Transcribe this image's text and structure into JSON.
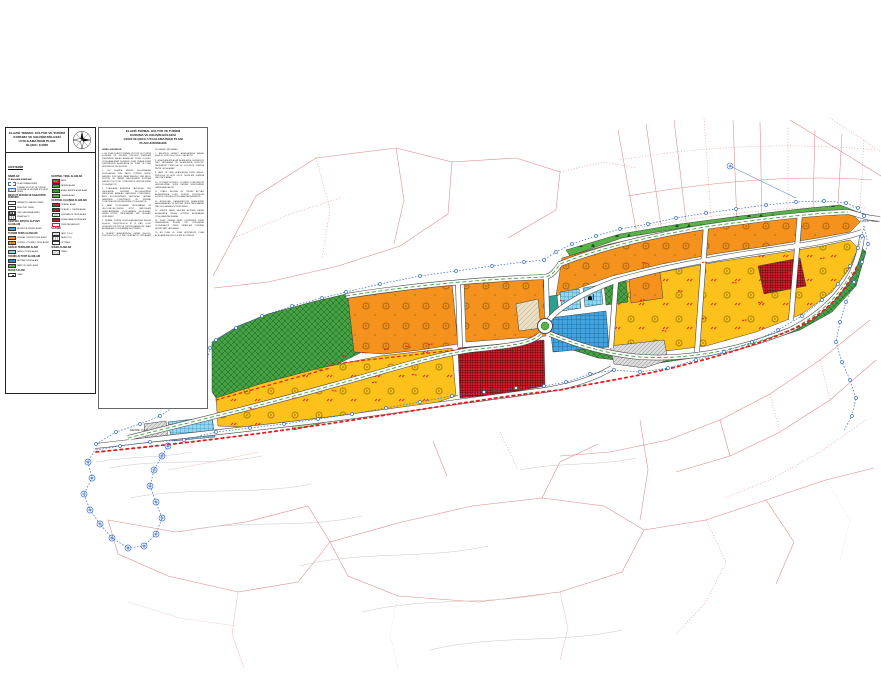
{
  "palette": {
    "orange": "#F5921E",
    "yellow": "#FCC21B",
    "red": "#D6202E",
    "green": "#44A244",
    "green_light": "#57B347",
    "cyan": "#8FD8F2",
    "blue": "#42A3DE",
    "boundary_blue": "#3B6FC4",
    "cadastral_red": "#D96A6A",
    "mark_red": "#E02020"
  },
  "titles": {
    "left_block": [
      "ELAZIĞ TERMAL KÜLTÜR VE TURİZM",
      "KORUMA VE GELİŞİM BÖLGESİ",
      "UYGULAMA İMAR PLANI",
      "ÖLÇEK: 1/1000"
    ],
    "right_block": [
      "ELAZIĞ TERMAL KÜLTÜR VE TURİZM",
      "KORUMA VE GELİŞİM BÖLGESİ",
      "1/1000 ÖLÇEKLİ UYGULAMA İMAR PLANI",
      "PLAN HÜKÜMLERİ"
    ]
  },
  "legend": {
    "heading": "GÖSTERİM",
    "groups_left": [
      {
        "header": "SINIRLAR",
        "sub": "PLANLAMA SINIRLARI",
        "items": [
          {
            "swatch": "plan-onama",
            "label": "PLAN ONAMA SINIRI"
          },
          {
            "swatch": "ktkgb",
            "label": "TERMAL KÜLTÜR VE TURİZM KORUMA VE GELİŞİM BÖLGESİ SINIRI"
          }
        ]
      },
      {
        "header": "MEVCUT DURUM VE KADASTRO DURUMU",
        "items": [
          {
            "swatch": "line-red-dash",
            "label": "KADASTRO PARSEL SINIRI"
          },
          {
            "swatch": "line-solid",
            "label": "MÜLKİYET SINIRI"
          },
          {
            "swatch": "line-dash",
            "label": "YAPI YAKLAŞMA SINIRI"
          },
          {
            "swatch": "line-dots",
            "label": "İFRAZ HATTI"
          }
        ]
      },
      {
        "header": "KENTSEL SOSYAL ALTYAPI ALANLARI",
        "items": [
          {
            "swatch": "blue",
            "label": "BELEDİYE HİZMET ALANI"
          }
        ]
      },
      {
        "header": "TURİZM TESİS ALANLARI",
        "items": [
          {
            "swatch": "orange",
            "label": "TERMAL TURİZM TESİS ALANI"
          },
          {
            "swatch": "orange2",
            "label": "TURİZM + TİCARET TESİS ALANI"
          }
        ]
      },
      {
        "header": "SAĞLIK TESİSLERİ ALANI",
        "items": [
          {
            "swatch": "cyan",
            "label": "SAĞLIK TESİSİ ALANI"
          }
        ]
      },
      {
        "header": "TEKNİK ALTYAPI ALANLARI",
        "items": [
          {
            "swatch": "blue2",
            "label": "ARITMA TESİSİ ALANI"
          },
          {
            "swatch": "green2",
            "label": "PARK VE YEŞİL ALAN"
          }
        ]
      },
      {
        "header": "İBADET ALANI",
        "items": [
          {
            "swatch": "mosque",
            "label": "CAMİ"
          }
        ]
      }
    ],
    "groups_right": [
      {
        "header": "KENTSEL YEŞİL ALANLAR",
        "items": [
          {
            "swatch": "green-red",
            "label": "PARK"
          },
          {
            "swatch": "green",
            "label": "MESİRE ALANI"
          },
          {
            "swatch": "green-h",
            "label": "AĞAÇLANDIRILACAK ALAN"
          },
          {
            "swatch": "green-t",
            "label": "ORMAN ALANI"
          }
        ]
      },
      {
        "header": "KENTSEL ÇALIŞMA ALANLARI",
        "items": [
          {
            "swatch": "red",
            "label": "TİCARET ALANI"
          },
          {
            "swatch": "red-h",
            "label": "TİCARET + TURİZM ALANI"
          },
          {
            "swatch": "red2",
            "label": "GÜNÜBİRLİK TESİS ALANI"
          },
          {
            "swatch": "red-h2",
            "label": "KONAKLAMA TESİS ALANI"
          },
          {
            "swatch": "red-b",
            "label": "YÖNETİM MERKEZİ"
          }
        ]
      },
      {
        "header": "ULAŞIM",
        "items": [
          {
            "swatch": "road",
            "label": "TAŞIT YOLU"
          },
          {
            "swatch": "road2",
            "label": "YAYA YOLU"
          },
          {
            "swatch": "park",
            "label": "OTOPARK"
          }
        ]
      },
      {
        "header": "DİĞER ALANLAR",
        "items": [
          {
            "swatch": "gray",
            "label": "TRAFO"
          }
        ]
      }
    ]
  },
  "provisions": {
    "paragraphs": [
      {
        "h": true,
        "t": "GENEL HÜKÜMLER"
      },
      {
        "h": false,
        "t": "1. BU PLAN, ELAZIĞ TERMAL KÜLTÜR VE TURİZM KORUMA VE GELİŞİM BÖLGESİ SINIRLARI İÇERİSİNDE KALAN ALANA AİT 1/1000 ÖLÇEKLİ UYGULAMA İMAR PLANIDIR. PLAN ONAMA SINIRI İÇERİSİNDEKİ ALANLARDA BU PLAN VE PLAN HÜKÜMLERİ GEÇERLİDİR."
      },
      {
        "h": false,
        "t": "2. BU PLANDA HÜKÜM BULUNMAYAN KONULARDA; 2634 SAYILI TURİZMİ TEŞVİK KANUNU, 3194 SAYILI İMAR KANUNU, 2863 SAYILI KÜLTÜR VE TABİAT VARLIKLARINI KORUMA KANUNU İLE İLGİLİ YÖNETMELİK HÜKÜMLERİNE UYULACAKTIR."
      },
      {
        "h": false,
        "t": "3. PLANLAMA ALANINDA YAPILACAK TÜM YAPILARDA; DEPREM BÖLGELERİNDE YAPILACAK BİNALAR HAKKINDA YÖNETMELİK, AFET BÖLGELERİNDE YAPILACAK YAPILAR HAKKINDA YÖNETMELİK VE SIĞINAK YÖNETMELİĞİ HÜKÜMLERİNE UYULACAKTIR."
      },
      {
        "h": false,
        "t": "4. İMAR UYGULAMASI YAPILMADAN VE JEOLOJİK-JEOTEKNİK ETÜT RAPORLARI ONAYLANMADAN UYGULAMAYA GEÇİLEMEZ. ZEMİN ETÜDÜ YAPILMADAN YAPI RUHSATI VERİLEMEZ."
      },
      {
        "h": false,
        "t": "5. TERMAL TURİZM TESİS ALANLARINDA; EMSAL (E)=0.60, YENÇOK=10.50 M. (3 KAT) OLUP, TESİSLER KÜLTÜR VE TURİZM BAKANLIĞI ONAYI ALINMADAN UYGULAMAYA GEÇİLEMEZ."
      },
      {
        "h": false,
        "t": "6. TİCARET ALANLARINDA; EMSAL (E)=0.50, YENÇOK=7.50 M. (2 KAT) OLACAKTIR. ÇATI ARASI KULLANIMI YAPILAMAZ."
      },
      {
        "h": false,
        "t": "7. BELEDİYE HİZMET ALANLARINDA EMSAL (E)=0.40, YENÇOK=7.50 M. OLACAKTIR."
      },
      {
        "h": false,
        "t": "8. AĞAÇLANDIRILACAK ALANLARDA KESİNLİKLE YAPI YAPILAMAZ. BU ALANLARDA SÖKÜLÜP TAKILABİLİR PERGOLA VE GÖLGELİK DIŞINDA ÜNİTE YER ALAMAZ."
      },
      {
        "h": false,
        "t": "9. PARK VE YEŞİL ALANLARDA; BÜFE, HAVUZ, PERGOLA VE AÇIK SPOR TESİSLERİ DIŞINDA YAPI YAPILAMAZ."
      },
      {
        "h": false,
        "t": "10. OTOPARK İHTİYACI; OTOPARK YÖNETMELİĞİ HÜKÜMLERİNE GÖRE PARSEL BÜNYESİNDE KARŞILANACAKTIR."
      },
      {
        "h": false,
        "t": "11. TRAFO, ARITMA VB. TEKNİK ALTYAPI ALANLARINDA İLGİLİ KURUM GÖRÜŞLERİ DOĞRULTUSUNDA UYGULAMA YAPILACAKTIR."
      },
      {
        "h": false,
        "t": "12. ATIKSULAR; KANALİZASYON ŞEBEKESİNE BAĞLANMADAN VE ARITMA TESİSİ YAPILMADAN YAPI KULLANMA İZNİ VERİLEMEZ."
      },
      {
        "h": false,
        "t": "13. ENERJİ NAKİL HATLARI ALTINDA KALAN ALANLARDA TEDAŞ GÖRÜŞÜ ALINMADAN UYGULAMA YAPILAMAZ."
      },
      {
        "h": false,
        "t": "14. PLAN ONAMA SINIRI İÇERİSİNDE DERE YATAKLARINA İLİŞKİN DSİ GÖRÜŞÜNE UYULACAKTIR. DERE YATAKLARI ÜZERİNE HİÇBİR YAPI YAPILAMAZ."
      },
      {
        "h": false,
        "t": "15. BU PLAN VE PLAN HÜKÜMLERİ, PLAN AÇIKLAMA RAPORU İLE BİR BÜTÜNDÜR."
      }
    ]
  },
  "map": {
    "labels": {
      "east_road": "CİRCİP YOLU",
      "west_road": "MEZRE YOLU"
    }
  }
}
